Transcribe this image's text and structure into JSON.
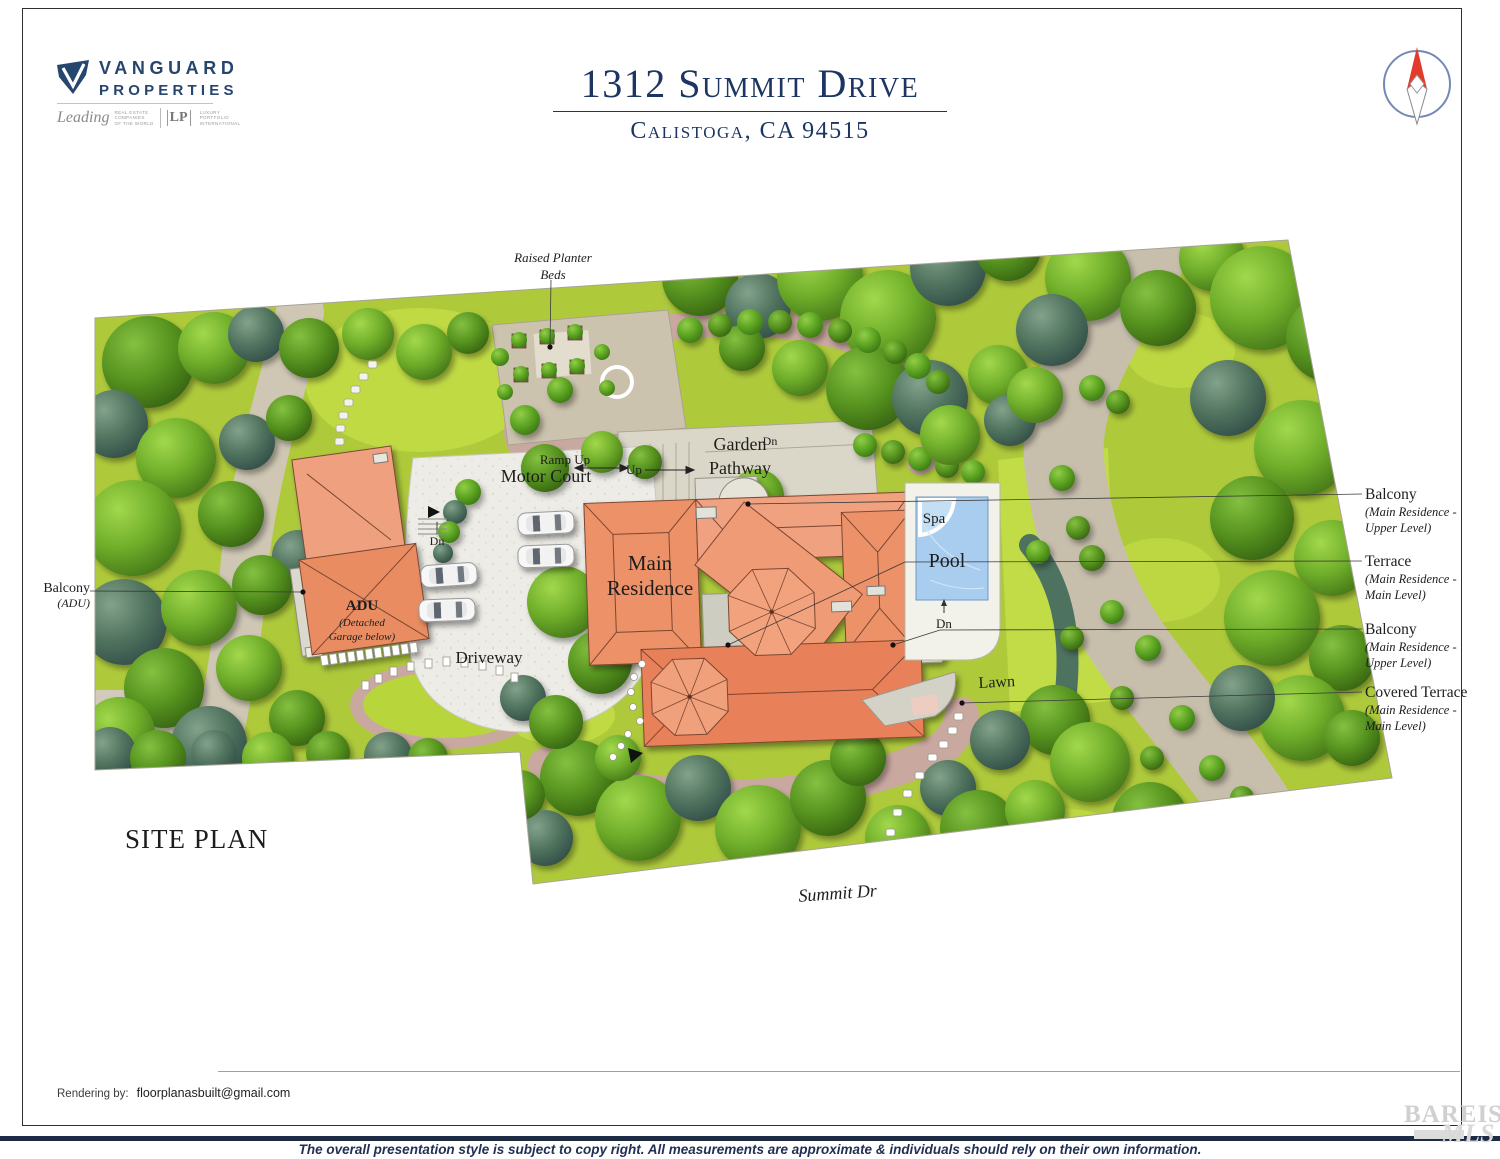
{
  "header": {
    "logo": {
      "name1": "VANGUARD",
      "name2": "PROPERTIES",
      "script": "Leading",
      "tag1": "REAL ESTATE",
      "tag2": "COMPANIES",
      "tag3": "OF THE WORLD",
      "lp": "LP",
      "lp1": "LUXURY",
      "lp2": "PORTFOLIO",
      "lp3": "INTERNATIONAL"
    },
    "title": "1312 Summit Drive",
    "subtitle": "Calistoga, CA 94515"
  },
  "plan": {
    "site_plan": "SITE PLAN",
    "street": "Summit Dr",
    "raised_planter_line1": "Raised Planter",
    "raised_planter_line2": "Beds",
    "ramp_up": "Ramp Up",
    "motor_court": "Motor Court",
    "up": "Up",
    "dn": "Dn",
    "garden_line1": "Garden",
    "garden_line2": "Pathway",
    "residence_line1": "Main",
    "residence_line2": "Residence",
    "spa": "Spa",
    "pool": "Pool",
    "adu": "ADU",
    "adu_sub1": "(Detached",
    "adu_sub2": "Garage below)",
    "driveway": "Driveway",
    "lawn": "Lawn",
    "balcony_adu_title": "Balcony",
    "balcony_adu_sub": "(ADU)"
  },
  "annotations": [
    {
      "title": "Balcony",
      "line1": "(Main Residence -",
      "line2": "Upper Level)"
    },
    {
      "title": "Terrace",
      "line1": "(Main Residence -",
      "line2": "Main Level)"
    },
    {
      "title": "Balcony",
      "line1": "(Main Residence -",
      "line2": "Upper Level)"
    },
    {
      "title": "Covered Terrace",
      "line1": "(Main Residence -",
      "line2": "Main Level)"
    }
  ],
  "footer": {
    "rendering_label": "Rendering by:",
    "rendering_email": "floorplanasbuilt@gmail.com",
    "copyright": "The overall presentation style is subject to copy right. All measurements are approximate & individuals should rely on their own information."
  },
  "watermark": {
    "brand": "BAREIS",
    "reg": "®",
    "mls": "MLS"
  },
  "colors": {
    "accent_navy": "#1c3562",
    "footer_navy": "#1e2b45",
    "roof_salmon": "#ec9168",
    "roof_deep": "#e8815a",
    "pool_blue": "#a9cdee",
    "lawn_green": "#aeca3b",
    "lawn_bright": "#c2dc48",
    "path_tan": "#cfc7b4",
    "mulch_pink": "#c9a8a0",
    "court_white": "#edece6",
    "compass_red": "#e23b2b",
    "tree_dark_teal": "#4a6a5d"
  }
}
